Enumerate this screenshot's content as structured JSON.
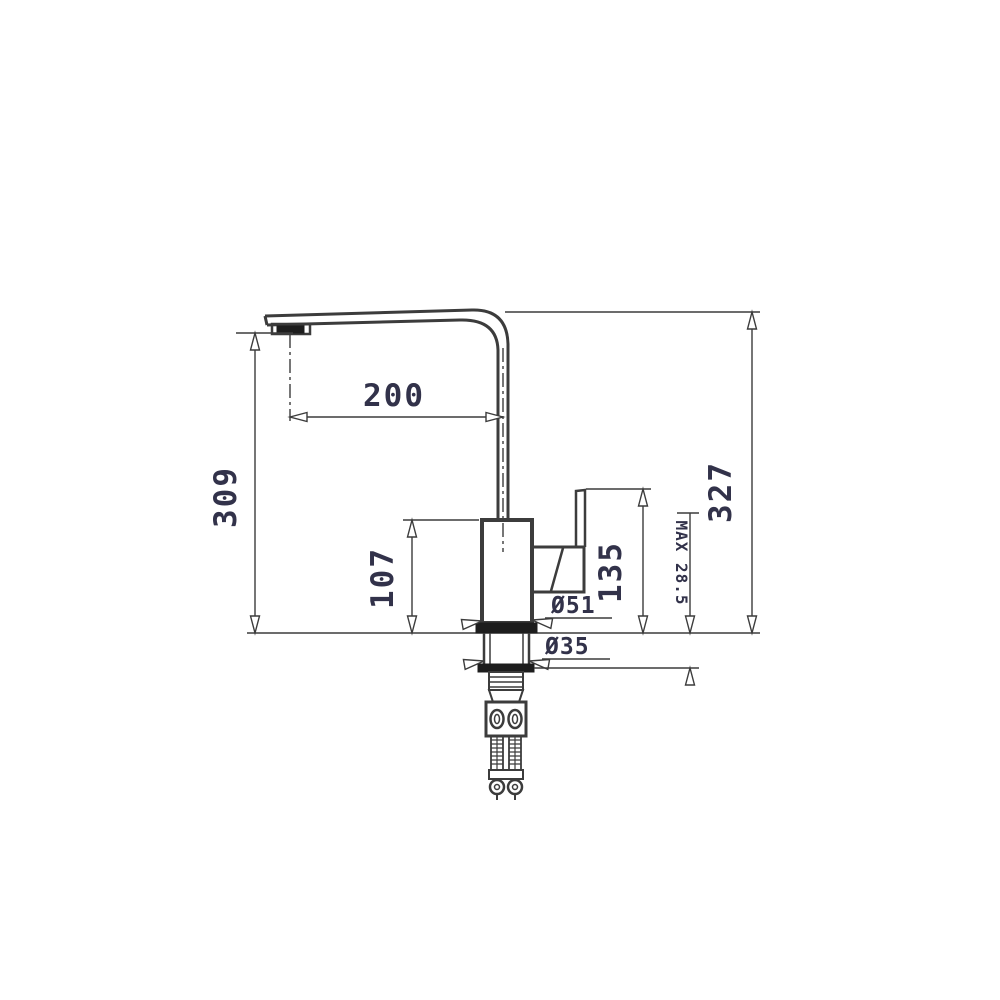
{
  "page": {
    "background": "#ffffff"
  },
  "drawing": {
    "type": "technical-dimension-drawing",
    "subject": "kitchen-mixer-tap-side-view",
    "line_color": "#3c3c3c",
    "text_color": "#32324a",
    "labels": {
      "spout_reach": "200",
      "spout_outlet_height": "309",
      "overall_height": "327",
      "body_height": "107",
      "lever_top_height": "135",
      "body_diameter": "Ø51",
      "shank_diameter": "Ø35",
      "max_deck_thickness": "MAX 28.5"
    }
  }
}
